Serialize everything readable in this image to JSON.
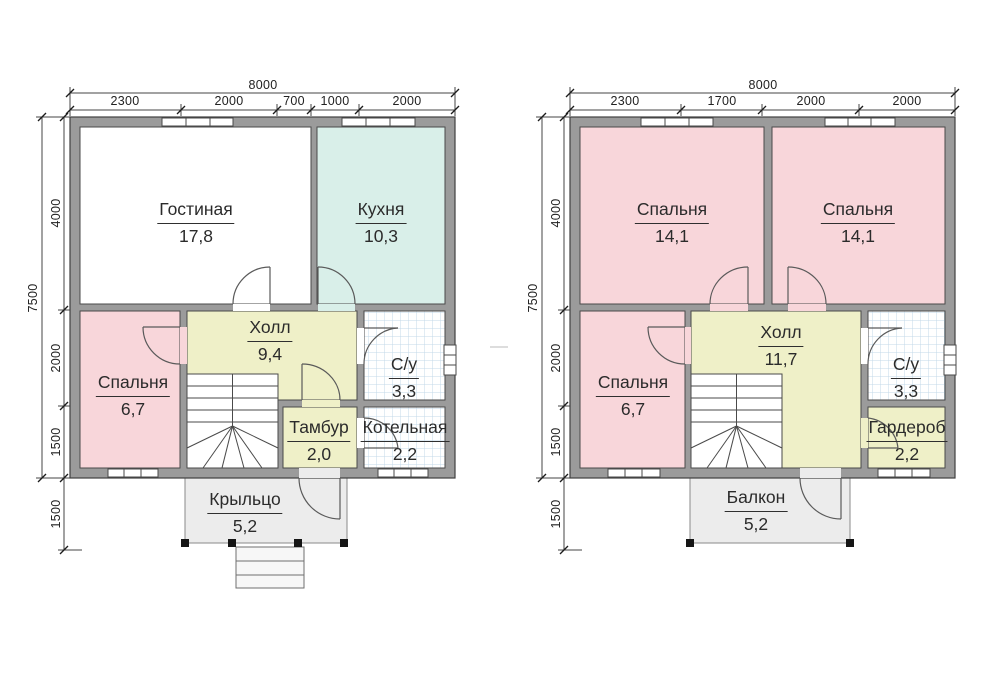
{
  "drawing": {
    "type": "house floor plans, 2 storeys",
    "language": "ru"
  },
  "palette": {
    "wall": "#9b9b9b",
    "wall_line": "#4a4a4a",
    "living_fill": "#ffffff",
    "kitchen_fill": "#d9efe9",
    "bedroom_fill": "#f8d6da",
    "hall_fill": "#eff0c8",
    "tile_line": "#c3d9e8",
    "porch_fill": "#ececec",
    "dim_color": "#222222"
  },
  "floors": [
    {
      "id": "floor1",
      "rooms": [
        {
          "name": "Гостиная",
          "area": "17,8"
        },
        {
          "name": "Кухня",
          "area": "10,3"
        },
        {
          "name": "Холл",
          "area": "9,4"
        },
        {
          "name": "Спальня",
          "area": "6,7"
        },
        {
          "name": "С/у",
          "area": "3,3"
        },
        {
          "name": "Тамбур",
          "area": "2,0"
        },
        {
          "name": "Котельная",
          "area": "2,2"
        },
        {
          "name": "Крыльцо",
          "area": "5,2"
        }
      ],
      "dims": {
        "total_width": "8000",
        "top_segments": [
          "2300",
          "2000",
          "700",
          "1000",
          "2000"
        ],
        "total_height": "7500",
        "left_segments": [
          "4000",
          "2000",
          "1500"
        ],
        "porch_depth": "1500"
      }
    },
    {
      "id": "floor2",
      "rooms": [
        {
          "name": "Спальня",
          "area": "14,1"
        },
        {
          "name": "Спальня",
          "area": "14,1"
        },
        {
          "name": "Холл",
          "area": "11,7"
        },
        {
          "name": "Спальня",
          "area": "6,7"
        },
        {
          "name": "С/у",
          "area": "3,3"
        },
        {
          "name": "Гардероб",
          "area": "2,2"
        },
        {
          "name": "Балкон",
          "area": "5,2"
        }
      ],
      "dims": {
        "total_width": "8000",
        "top_segments": [
          "2300",
          "1700",
          "2000",
          "2000"
        ],
        "total_height": "7500",
        "left_segments": [
          "4000",
          "2000",
          "1500"
        ],
        "balcony_depth": "1500"
      }
    }
  ]
}
